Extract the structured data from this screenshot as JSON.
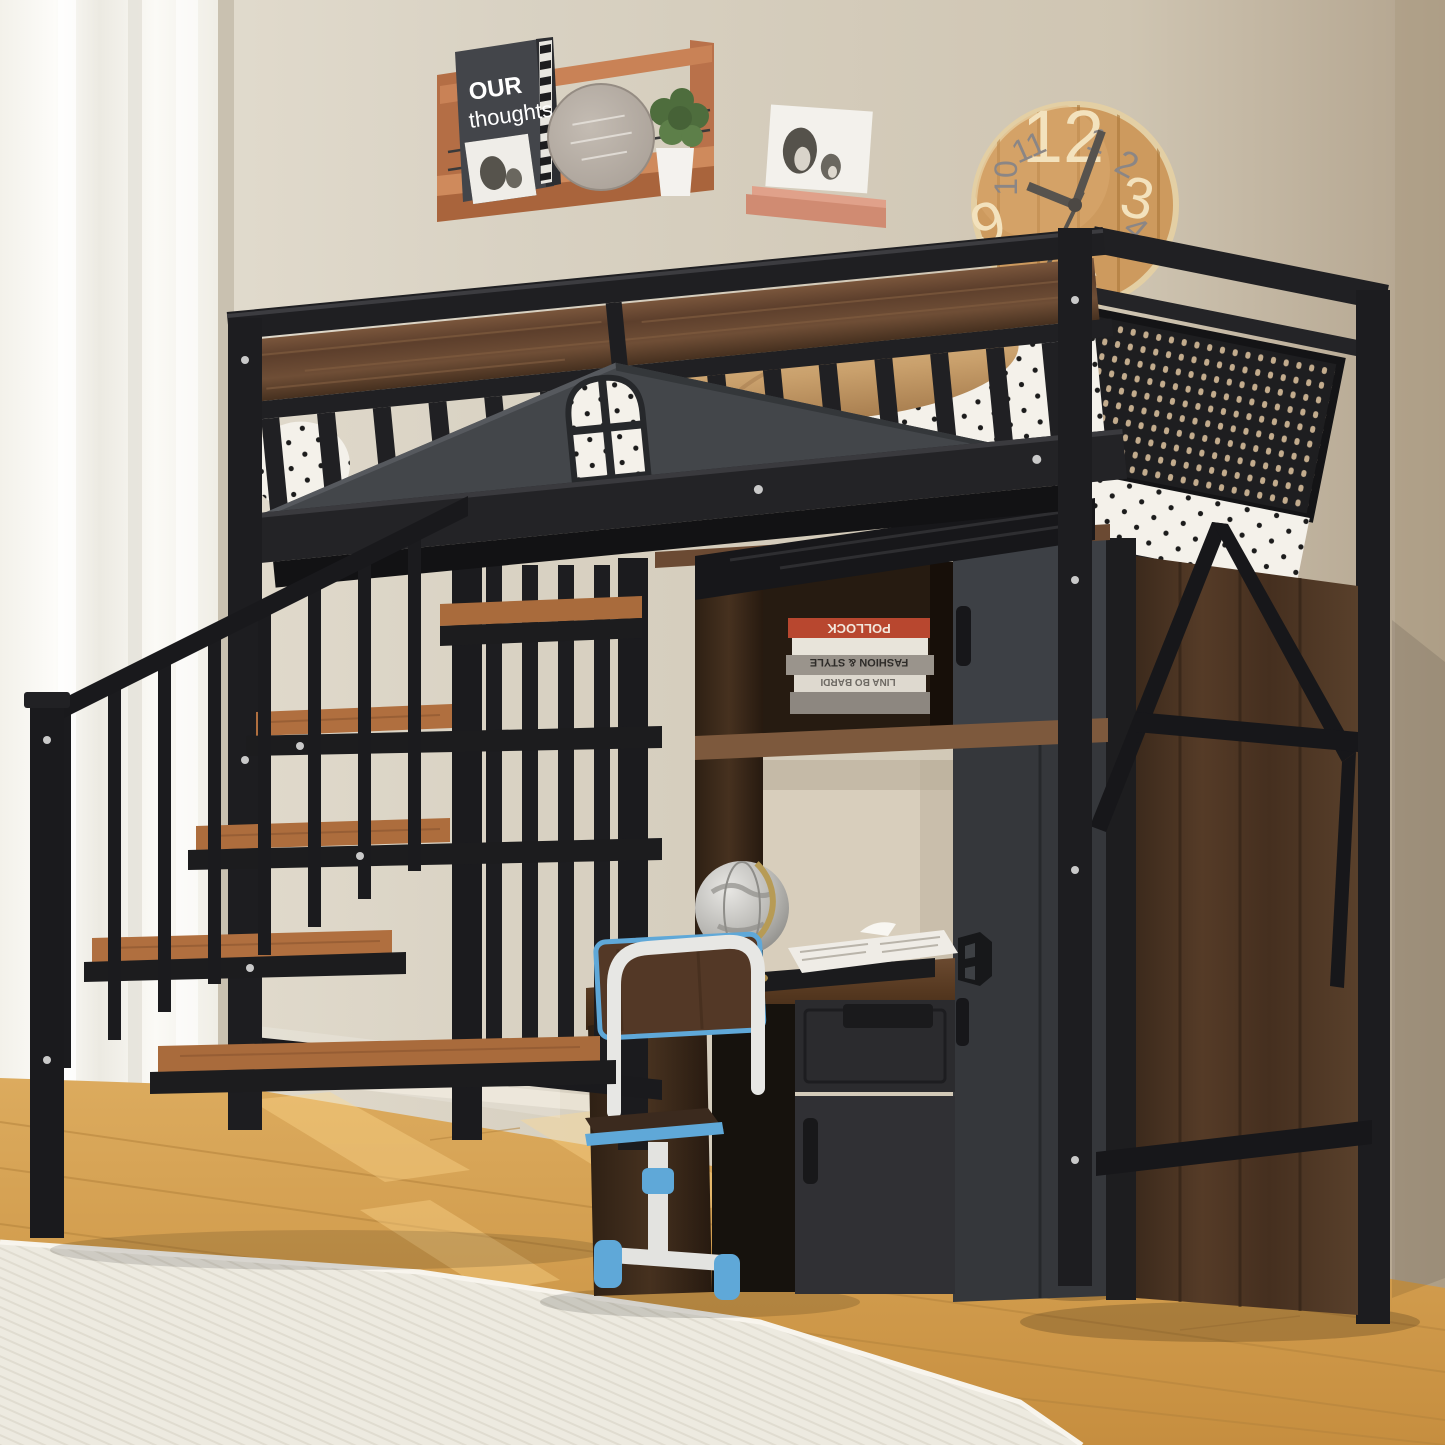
{
  "scene": {
    "name": "Kids room product photo: black metal loft bed with staircase, built-in desk, bookshelf hutch and wardrobe"
  },
  "wall_shelf": {
    "book_line1": "OUR",
    "book_line2": "thoughts"
  },
  "hutch_books": {
    "book1": "POLLOCK",
    "book2": "FASHION & STYLE",
    "book3": "LINA BO BARDI"
  },
  "clock": {
    "n12": "12",
    "n1": "1",
    "n2": "2",
    "n3": "3",
    "n4": "4",
    "n6": "6",
    "n7": "7",
    "n9": "9",
    "n10": "10",
    "n11": "11"
  },
  "colors": {
    "metal_black": "#1f1f22",
    "gable_gray": "#43464a",
    "wardrobe_gray": "#37393d",
    "walnut_dark": "#4a3322",
    "walnut_light": "#6b4a33",
    "shelf_wood": "#c0714a",
    "clock_wood": "#cd9a5e",
    "chair_blue": "#5fa8d8",
    "book_red": "#b8472f",
    "wall_beige": "#d6cfc0",
    "floor_wood": "#d2a054",
    "rug_cream": "#ebe7dc",
    "bedding_white": "#f4f1ea",
    "blanket_tan": "#cfa875"
  }
}
